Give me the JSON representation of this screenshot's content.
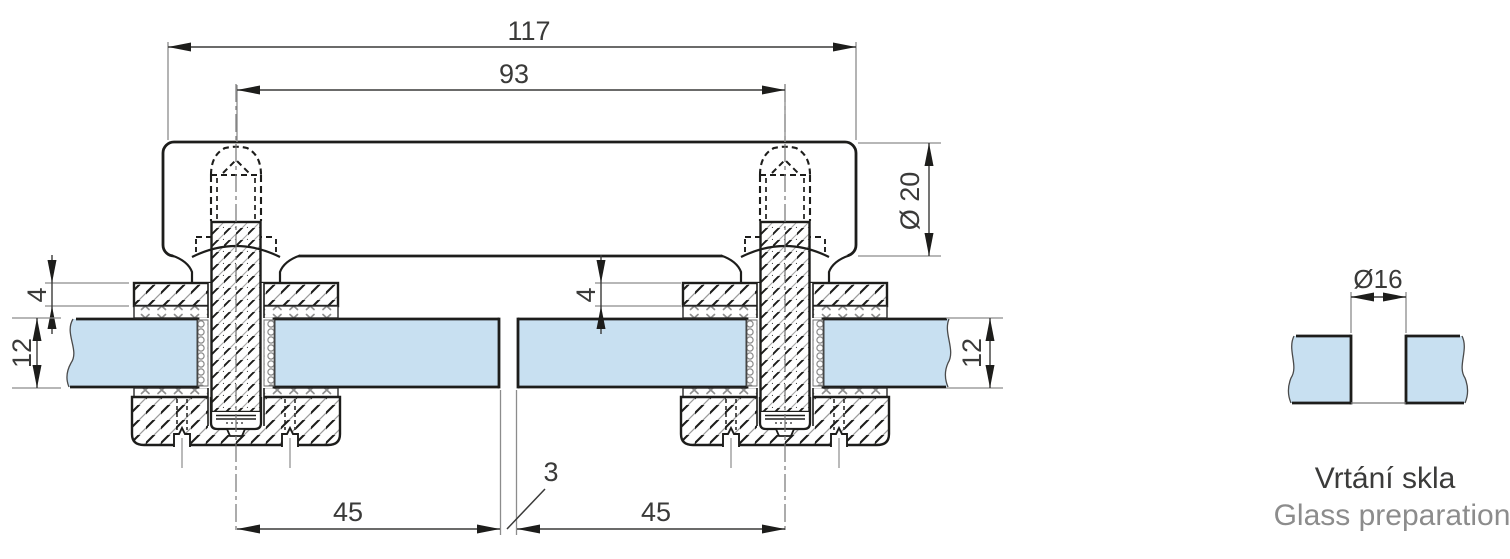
{
  "drawing": {
    "dimensions": {
      "overall_length": "117",
      "bolt_spacing": "93",
      "tube_diameter": "Ø 20",
      "clamp_plate_thickness_left": "4",
      "glass_thickness_left": "12",
      "clamp_plate_thickness_middle": "4",
      "glass_thickness_right": "12",
      "edge_distance_left": "45",
      "glass_gap": "3",
      "edge_distance_right": "45",
      "hole_diameter": "Ø16"
    },
    "captions": {
      "czech": "Vrtání skla",
      "english": "Glass preparation"
    },
    "colors": {
      "glass": "#c8e0f1",
      "line": "#1d1d1b",
      "dimension": "#3a3a39",
      "extension": "#8c8c8c",
      "caption_primary": "#3b3b3a",
      "caption_secondary": "#8c8c8c"
    }
  }
}
